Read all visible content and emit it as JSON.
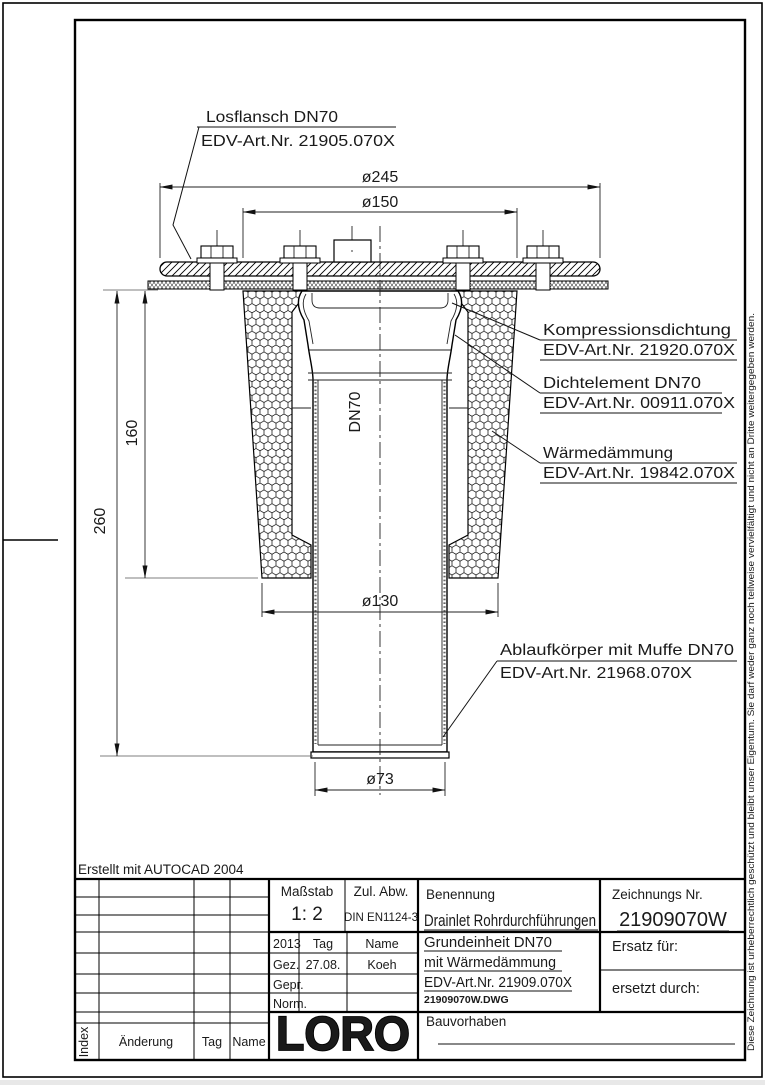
{
  "page": {
    "erstellt_note": "Erstellt mit AUTOCAD 2004",
    "copyright_vertical": "Diese Zeichnung ist urheberrechtlich geschützt und bleibt unser Eigentum. Sie darf weder ganz noch teilweise vervielfältigt und nicht an Dritte weitergegeben werden."
  },
  "labels": {
    "losflansch": {
      "line1": "Losflansch DN70",
      "line2": "EDV-Art.Nr. 21905.070X"
    },
    "kompressionsdichtung": {
      "line1": "Kompressionsdichtung",
      "line2": "EDV-Art.Nr. 21920.070X"
    },
    "dichtelement": {
      "line1": "Dichtelement DN70",
      "line2": "EDV-Art.Nr. 00911.070X"
    },
    "waermedaemmung": {
      "line1": "Wärmedämmung",
      "line2": "EDV-Art.Nr. 19842.070X"
    },
    "ablaufkoerper": {
      "line1": "Ablaufkörper mit Muffe DN70",
      "line2": "EDV-Art.Nr. 21968.070X"
    }
  },
  "dimensions": {
    "d245": "ø245",
    "d150": "ø150",
    "h160": "160",
    "h260": "260",
    "d130": "ø130",
    "d73": "ø73",
    "dn70": "DN70"
  },
  "titleblock": {
    "massstab_label": "Maßstab",
    "massstab_value": "1: 2",
    "zul_abw_label": "Zul. Abw.",
    "zul_abw_value": "DIN EN1124-3",
    "year": "2013",
    "tag_label": "Tag",
    "name_label": "Name",
    "gez_label": "Gez.",
    "gez_tag": "27.08.",
    "gez_name": "Koeh",
    "gepr_label": "Gepr.",
    "norm_label": "Norm.",
    "benennung_label": "Benennung",
    "benennung_value": "Drainlet Rohrdurchführungen",
    "zeichnungs_nr_label": "Zeichnungs Nr.",
    "zeichnungs_nr_value": "21909070W",
    "desc_line1": "Grundeinheit DN70",
    "desc_line2": "mit Wärmedämmung",
    "desc_line3": "EDV-Art.Nr. 21909.070X",
    "file_name": "21909070W.DWG",
    "ersatz_label": "Ersatz für:",
    "ersetzt_label": "ersetzt durch:",
    "bauvorhaben_label": "Bauvorhaben",
    "logo": "LORO",
    "index_label": "Index",
    "aenderung_label": "Änderung",
    "tag_col_label": "Tag",
    "name_col_label": "Name"
  }
}
